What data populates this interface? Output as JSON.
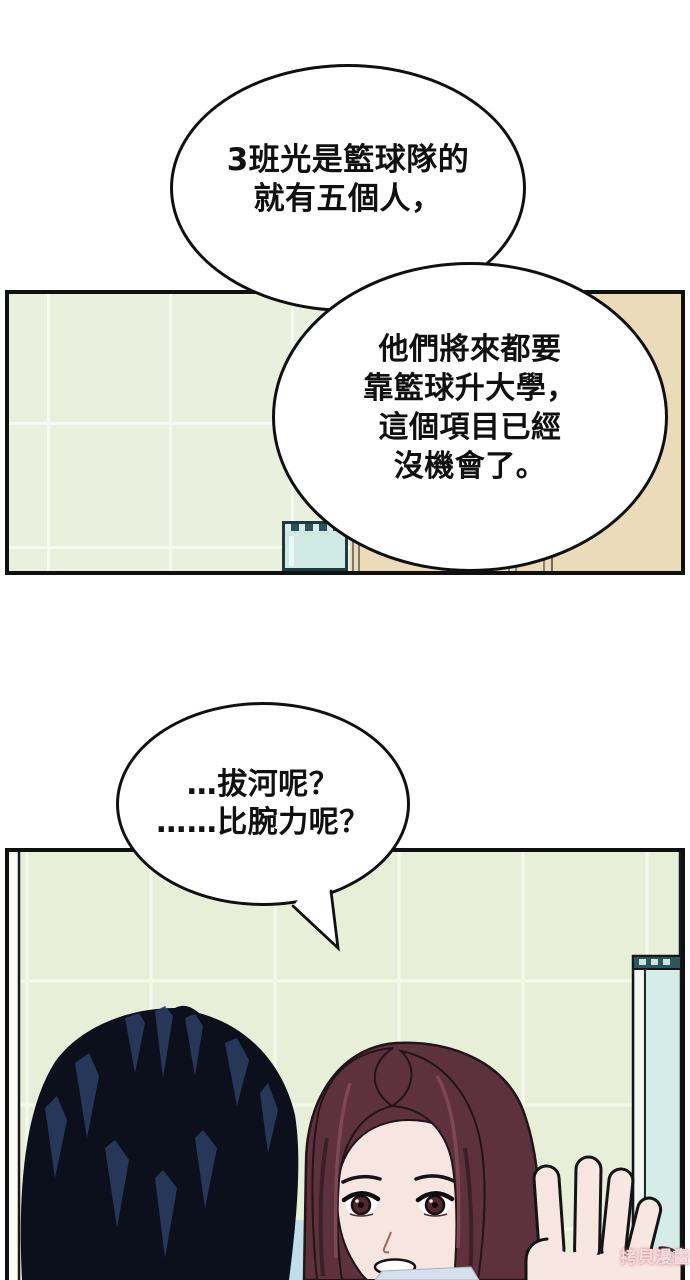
{
  "bubbles": {
    "bubble1": {
      "lines": [
        "3班光是籃球隊的",
        "就有五個人，"
      ]
    },
    "bubble2": {
      "lines": [
        "他們將來都要",
        "靠籃球升大學，",
        "這個項目已經",
        "沒機會了。"
      ]
    },
    "bubble3": {
      "lines": [
        "…拔河呢？",
        "……比腕力呢？"
      ]
    }
  },
  "watermark": {
    "text": "拷貝漫畫",
    "color": "#f3e3e3",
    "outline_color": "#d6808c"
  },
  "scene": {
    "panel1": {
      "wall_color": "#e9f0dd",
      "tile_line_color": "#f7faf0",
      "door_color": "#ecdbb8",
      "tank_glass_color": "#cfe9e3",
      "tank_frame_color": "#1b3a42"
    },
    "panel2": {
      "wall_color": "#e7efd9",
      "window_glass_color": "#d6ece6",
      "window_frame_color": "#2c565e"
    },
    "characters": {
      "left_character": {
        "hair_color": "#0c101d",
        "hair_highlight_color": "#2a3d62"
      },
      "woman": {
        "hair_color": "#5d323c",
        "hair_highlight_color": "#7d4854",
        "skin_color": "#f7e5e2",
        "iris_color": "#512a31"
      }
    },
    "bubble_border_color": "#101010",
    "panel_border_color": "#101010"
  }
}
